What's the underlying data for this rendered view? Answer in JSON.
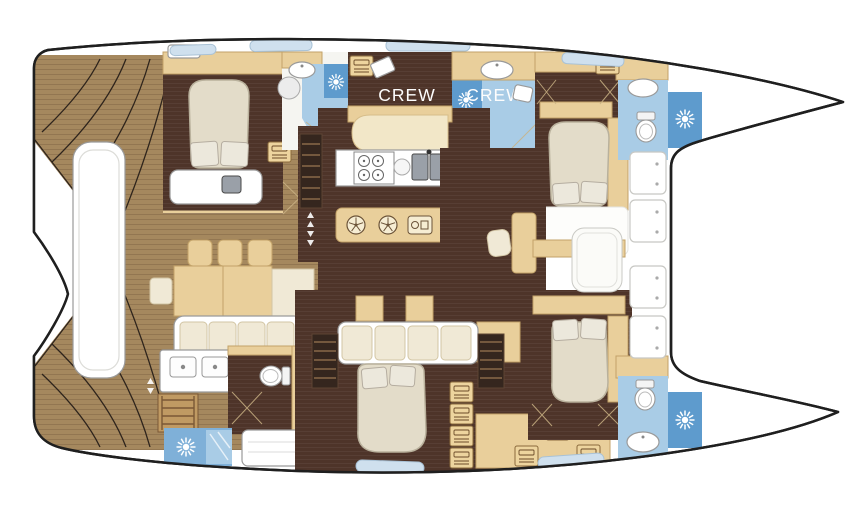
{
  "diagram": {
    "kind": "catamaran-yacht-floor-plan",
    "labels": {
      "crew_port_cabin": "CREW",
      "crew_starboard_cabin": "CREW"
    },
    "colors": {
      "hull_outline": "#1f1f1f",
      "deck_wood": "#a5885e",
      "deck_wood_line": "#7e6342",
      "cabin_floor": "#4e3429",
      "furniture_tan": "#e9cf9b",
      "furniture_tan_border": "#c2a268",
      "cushion_cream": "#f0e9d6",
      "bed_linen": "#e3dcc9",
      "bathroom_blue": "#a9cce6",
      "bathroom_blue_dark": "#5e9bcd",
      "hatch_blue": "#cfe0ee",
      "fixture_white": "#ffffff",
      "line_gray": "#9a9a9a",
      "sink_steel": "#9aa0a8"
    },
    "icons": {
      "shower_sun": "sun-burst",
      "vent_fan": "round-vent",
      "toilet": "wc-bowl",
      "berth_storage": "bunk-box",
      "stove": "four-burner-hob",
      "double_sink": "twin-steel-sink",
      "deck_locker": "dotted-hatch"
    }
  }
}
